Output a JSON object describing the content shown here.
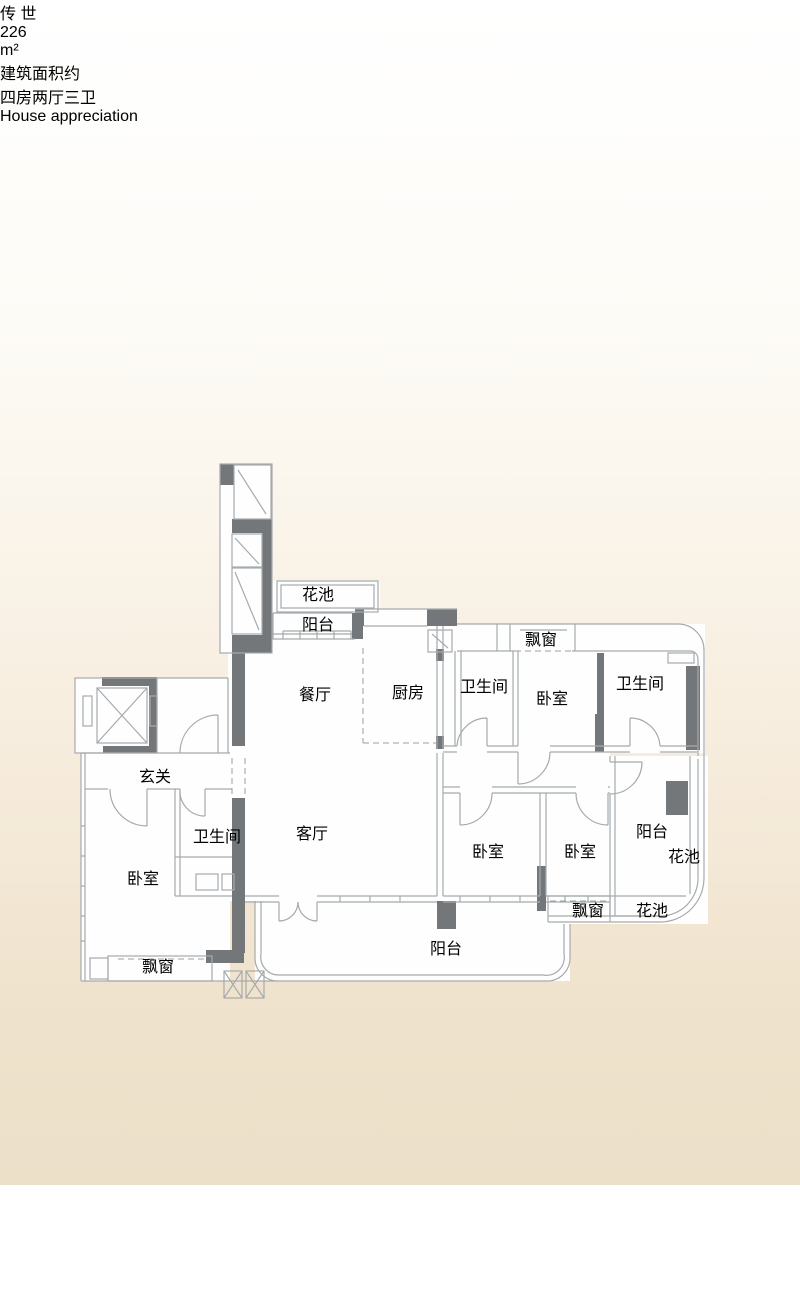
{
  "header": {
    "series_chars": [
      "传",
      "世"
    ],
    "area_value": "226",
    "area_unit": "m²",
    "area_caption": "建筑面积约",
    "layout_title": "四房两厅三卫",
    "layout_subtitle": "House appreciation"
  },
  "floorplan": {
    "labels": [
      {
        "id": "flower-bed-top",
        "text": "花池"
      },
      {
        "id": "balcony-top",
        "text": "阳台"
      },
      {
        "id": "dining-room",
        "text": "餐厅"
      },
      {
        "id": "kitchen",
        "text": "厨房"
      },
      {
        "id": "bathroom-top-middle",
        "text": "卫生间"
      },
      {
        "id": "bay-window-top",
        "text": "飘窗"
      },
      {
        "id": "bedroom-top",
        "text": "卧室"
      },
      {
        "id": "bathroom-top-right",
        "text": "卫生间"
      },
      {
        "id": "entry-hall",
        "text": "玄关"
      },
      {
        "id": "bathroom-left",
        "text": "卫生间"
      },
      {
        "id": "bedroom-left",
        "text": "卧室"
      },
      {
        "id": "living-room",
        "text": "客厅"
      },
      {
        "id": "bedroom-bottom-middle",
        "text": "卧室"
      },
      {
        "id": "bedroom-bottom-right",
        "text": "卧室"
      },
      {
        "id": "balcony-right",
        "text": "阳台"
      },
      {
        "id": "flower-bed-right",
        "text": "花池"
      },
      {
        "id": "bay-window-bottom-right",
        "text": "飘窗"
      },
      {
        "id": "flower-bed-bottom",
        "text": "花池"
      },
      {
        "id": "balcony-bottom",
        "text": "阳台"
      },
      {
        "id": "bay-window-bottom-left",
        "text": "飘窗"
      }
    ]
  },
  "colors": {
    "band_overlay": "#c5a47e",
    "accent_orange": "#f0b183",
    "wall_dark": "#74777a",
    "wall_line": "#a6aaad",
    "label_gray": "#8d9296",
    "background_bottom": "#ece0c9",
    "text_white": "#ffffff"
  }
}
